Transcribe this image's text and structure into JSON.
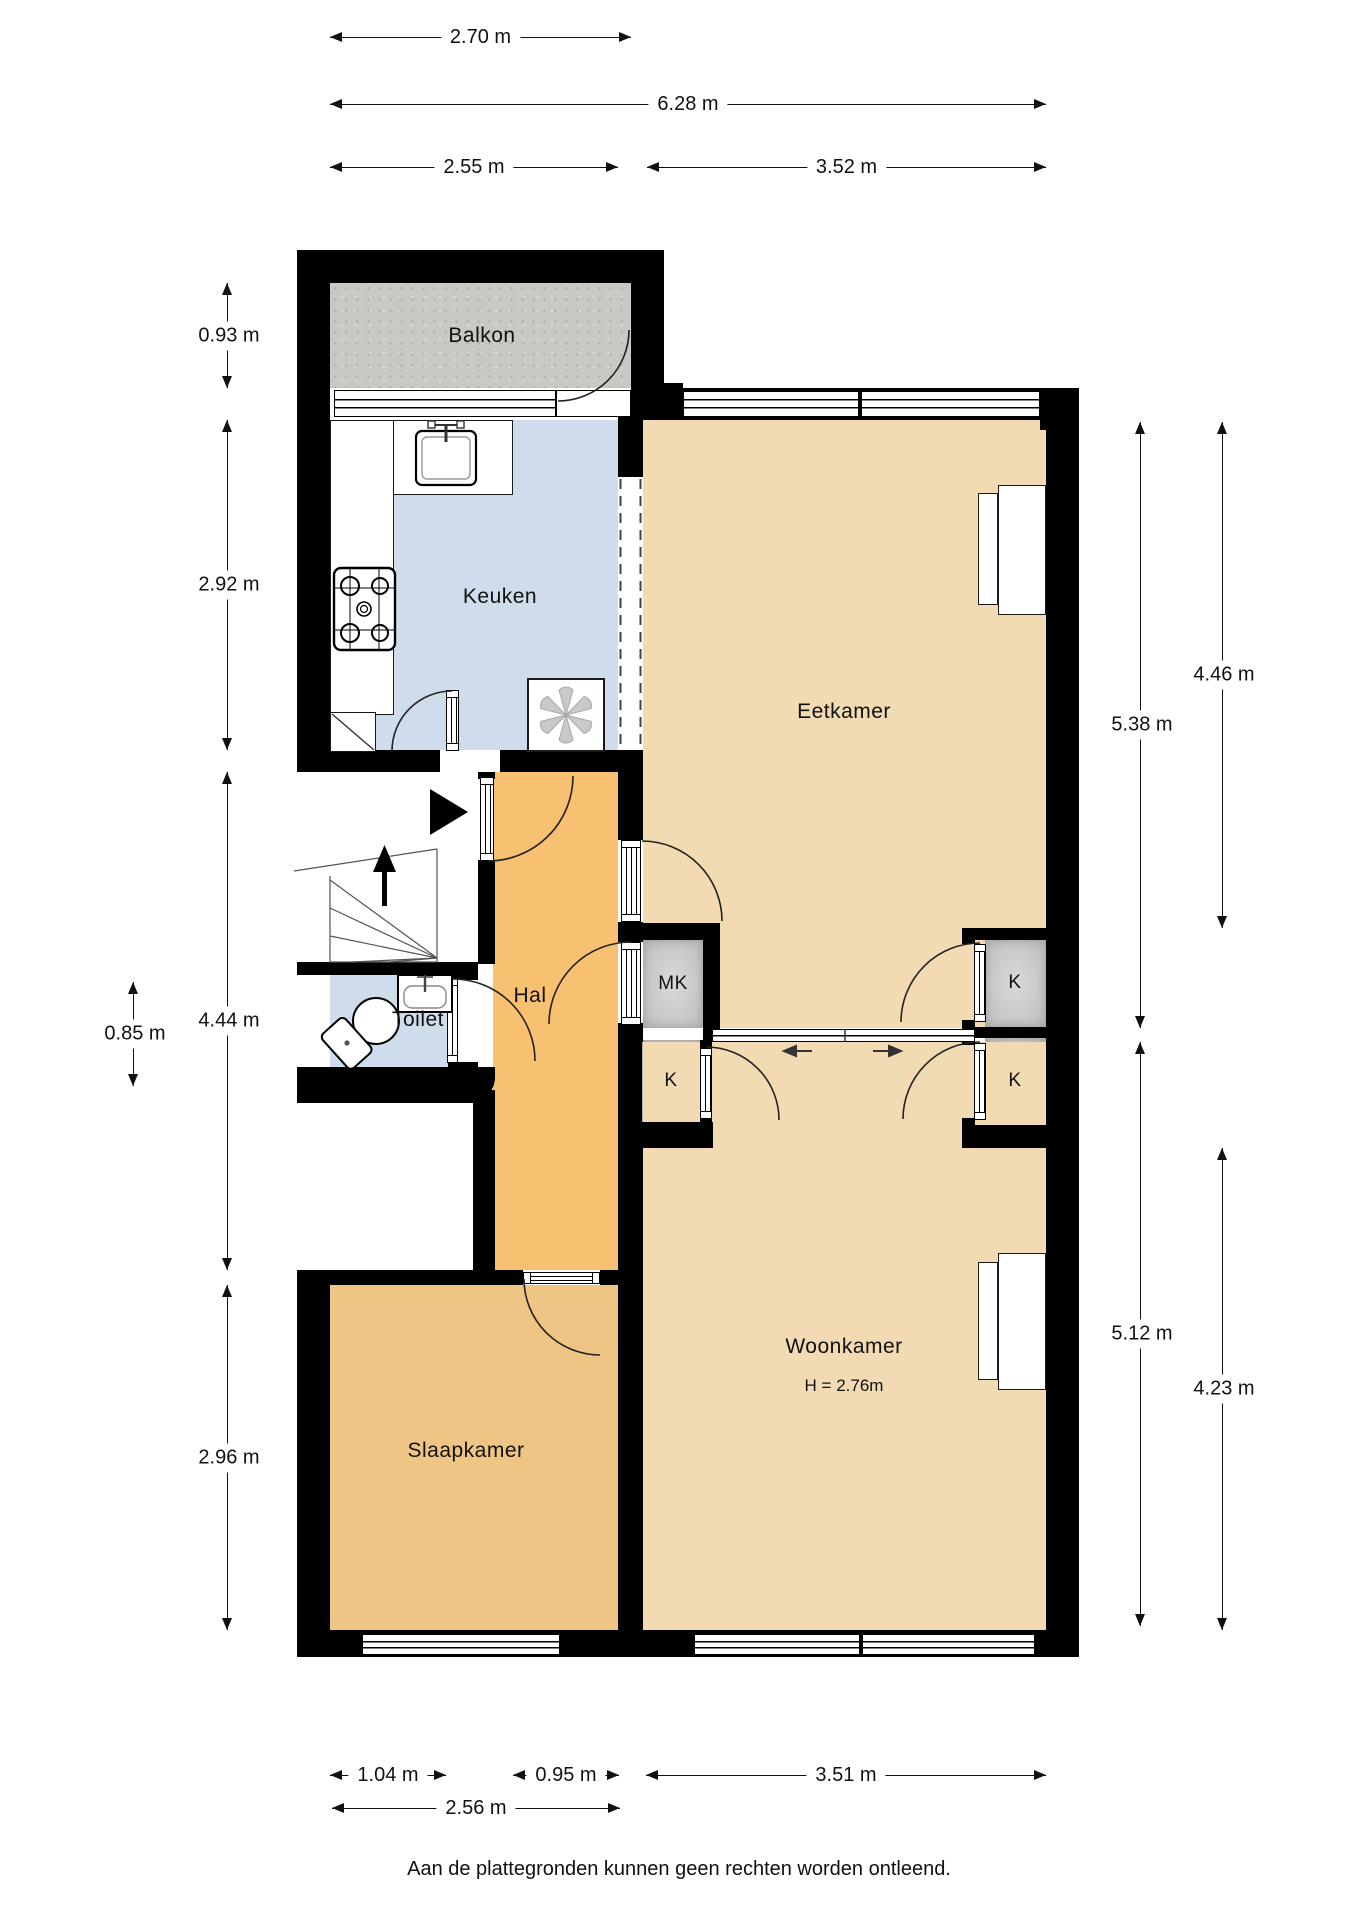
{
  "rooms": {
    "balkon": {
      "label": "Balkon"
    },
    "keuken": {
      "label": "Keuken"
    },
    "eetkamer": {
      "label": "Eetkamer"
    },
    "hal": {
      "label": "Hal"
    },
    "toilet": {
      "label": "Toilet"
    },
    "meterkast": {
      "label": "MK"
    },
    "closet_hall": {
      "label": "K"
    },
    "closet_dining": {
      "label": "K"
    },
    "closet_living": {
      "label": "K"
    },
    "woonkamer": {
      "label": "Woonkamer",
      "height_note": "H = 2.76m"
    },
    "slaapkamer": {
      "label": "Slaapkamer"
    }
  },
  "dimensions": {
    "balcony_width": "2.70 m",
    "total_width": "6.28 m",
    "kitchen_width": "2.55 m",
    "dining_width": "3.52 m",
    "balcony_depth": "0.93 m",
    "kitchen_depth": "2.92 m",
    "hall_depth": "4.44 m",
    "toilet_depth": "0.85 m",
    "bedroom_depth": "2.96 m",
    "dining_depth_total": "5.38 m",
    "dining_depth_inner": "4.46 m",
    "living_depth_total": "5.12 m",
    "living_depth_inner": "4.23 m",
    "bedroom_pier_width": "1.04 m",
    "hall_bottom_width": "0.95 m",
    "living_width": "3.51 m",
    "bedroom_width": "2.56 m"
  },
  "footer": {
    "disclaimer": "Aan de plattegronden kunnen geen rechten worden ontleend."
  },
  "colors": {
    "wall": "#000000",
    "living_floor": "#f2dbb2",
    "hall_floor": "#f8c071",
    "bedroom_floor": "#eec584",
    "kitchen_floor": "#cfdcec",
    "balcony_floor": "#c9c8c2",
    "closet_floor": "#c9c9c9"
  }
}
